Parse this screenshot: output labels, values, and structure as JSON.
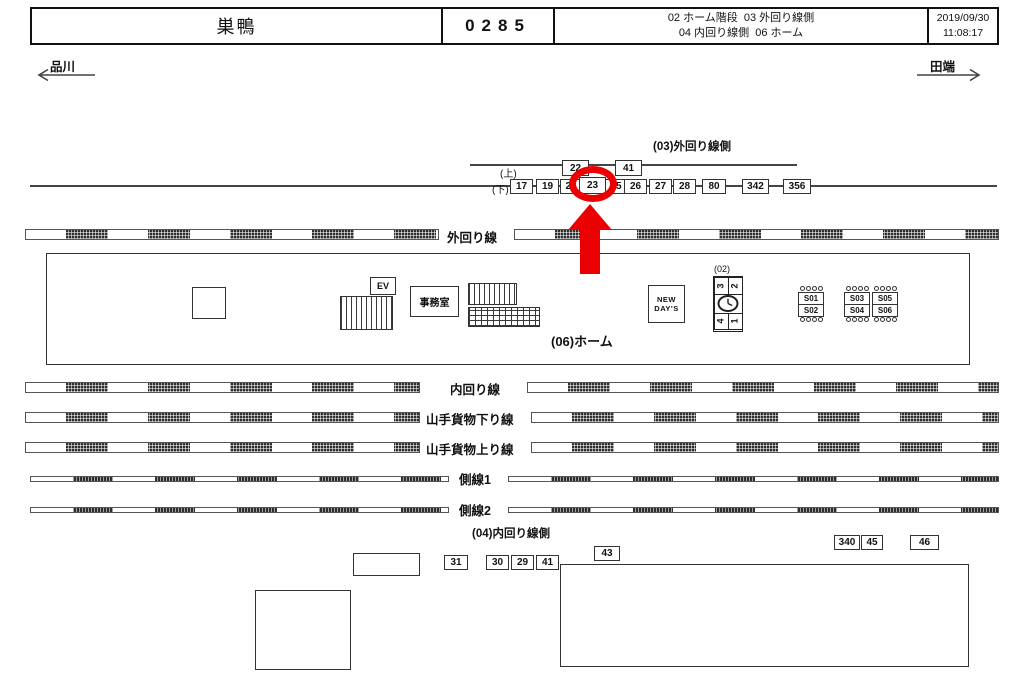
{
  "header": {
    "station_name": "巣鴨",
    "station_code": "0285",
    "legend_line1": "02 ホーム階段  03 外回り線側",
    "legend_line2": "04 内回り線側  06 ホーム",
    "date": "2019/09/30",
    "time": "11:08:17"
  },
  "directions": {
    "left": "品川",
    "right": "田端"
  },
  "labels": {
    "outer_side": "(03)外回り線側",
    "inner_side": "(04)内回り線側",
    "platform": "(06)ホーム",
    "stair_block": "(02)",
    "row_up": "(上)",
    "row_down": "(下)"
  },
  "tracks": [
    "外回り線",
    "内回り線",
    "山手貨物下り線",
    "山手貨物上り線",
    "側線1",
    "側線2"
  ],
  "cameras": {
    "outer_up": [
      "22",
      "41"
    ],
    "outer_down": [
      "17",
      "19",
      "21",
      "23",
      "25",
      "26",
      "27",
      "28",
      "80",
      "342",
      "356"
    ],
    "highlighted": "23",
    "inner": [
      "31",
      "30",
      "29",
      "41",
      "43",
      "340",
      "45",
      "46"
    ]
  },
  "platform": {
    "office": "事務室",
    "elevator": "EV",
    "shop_line1": "NEW",
    "shop_line2": "DAY'S",
    "stair_numbers": [
      "3",
      "2",
      "4",
      "1"
    ],
    "benches": [
      [
        "S01",
        "S02"
      ],
      [
        "S03",
        "S04"
      ],
      [
        "S05",
        "S06"
      ]
    ]
  },
  "colors": {
    "highlight_red": "#ea0000"
  }
}
